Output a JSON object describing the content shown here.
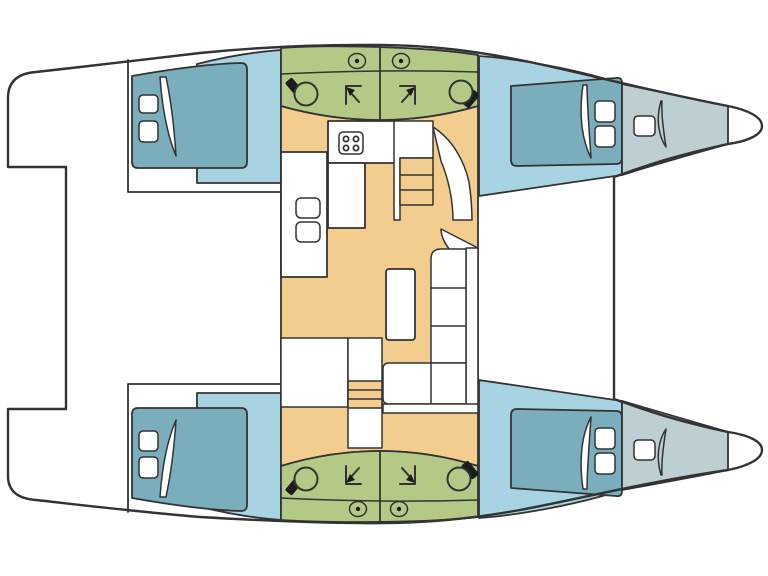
{
  "title": "Catamaran interior floor plan",
  "image": {
    "width": 768,
    "height": 576,
    "view": "top-down",
    "orientation": "bows pointing right"
  },
  "colors": {
    "outline": "#333333",
    "white": "#ffffff",
    "salon_floor": "#f2cd8e",
    "bathroom_floor": "#b5c987",
    "cabin_floor": "#a8d3e2",
    "bed": "#7aaebc",
    "forepeak": "#bdcfd3",
    "fixture_dark": "#1c1c1c"
  },
  "plan": {
    "hulls": 2,
    "cabins": [
      {
        "id": "port-aft-cabin",
        "type": "double berth cabin",
        "items": [
          "double bed",
          "2 pillows",
          "duvet fold"
        ]
      },
      {
        "id": "port-forward-cabin",
        "type": "double berth cabin",
        "items": [
          "double bed",
          "2 pillows",
          "duvet fold"
        ]
      },
      {
        "id": "starboard-aft-cabin",
        "type": "double berth cabin",
        "items": [
          "double bed",
          "2 pillows",
          "duvet fold"
        ]
      },
      {
        "id": "starboard-forward-cabin",
        "type": "double berth cabin",
        "items": [
          "double bed",
          "2 pillows",
          "duvet fold"
        ]
      }
    ],
    "bathrooms": [
      {
        "id": "port-aft-head",
        "items": [
          "toilet",
          "shower",
          "porthole"
        ]
      },
      {
        "id": "port-forward-head",
        "items": [
          "toilet",
          "shower",
          "porthole"
        ]
      },
      {
        "id": "starboard-aft-head",
        "items": [
          "toilet",
          "shower",
          "porthole"
        ]
      },
      {
        "id": "starboard-forward-head",
        "items": [
          "toilet",
          "shower",
          "porthole"
        ]
      }
    ],
    "salon": {
      "items": [
        "galley counter",
        "4-burner stove",
        "double sink",
        "worktop",
        "L-shaped sofa",
        "rectangular table",
        "storage unit",
        "steps to port hull",
        "steps to starboard hull"
      ]
    },
    "foredeck": {
      "items": [
        "port forepeak locker with deck hatch",
        "starboard forepeak locker with deck hatch"
      ]
    },
    "stern": {
      "items": [
        "port transom platform",
        "starboard transom platform",
        "aft deck"
      ]
    }
  }
}
